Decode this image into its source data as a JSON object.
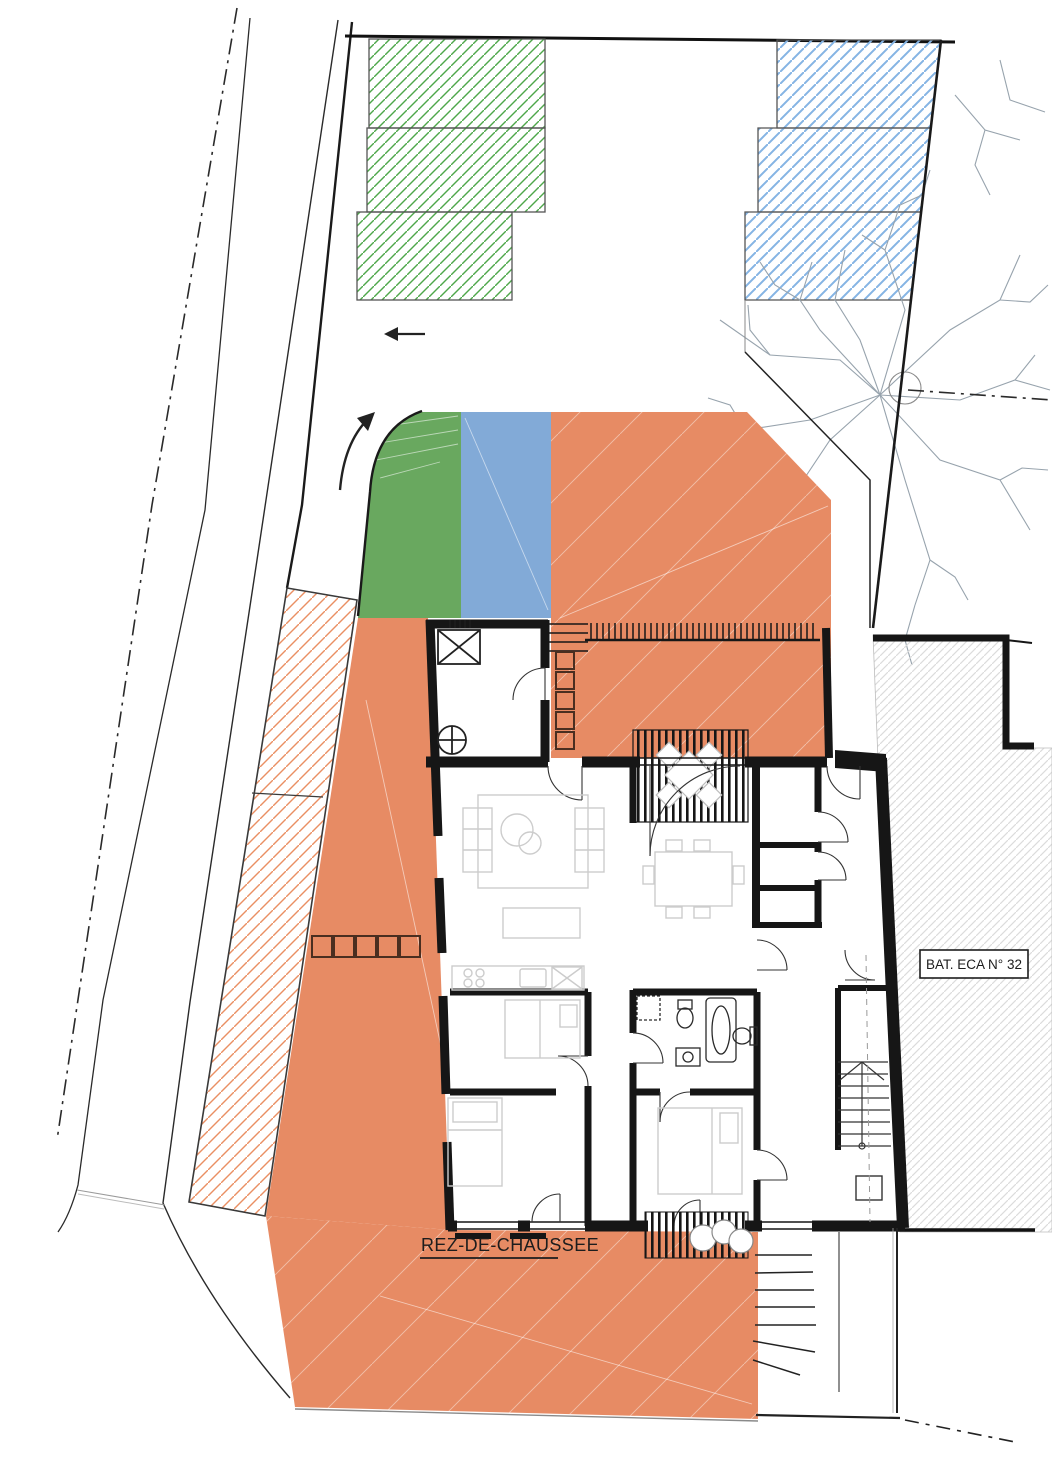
{
  "drawing": {
    "floor_label": "REZ-DE-CHAUSSEE",
    "neighbor_label": "BAT. ECA N° 32",
    "colors": {
      "zone_green": "#69a85f",
      "zone_blue": "#82aad7",
      "zone_orange": "#e78b64",
      "strip_hatch": "#ea8f63",
      "parking_green_hatch": "#4ea74a",
      "parking_blue_hatch": "#85b4e4",
      "neighbor_hatch": "#dcdcdc",
      "wall": "#161616",
      "tree_branches": "#97a3ad"
    },
    "hatched_blocks": {
      "green_count": 3,
      "blue_count": 3
    },
    "arrows": {
      "straight": "left",
      "curved": "up-right"
    }
  }
}
